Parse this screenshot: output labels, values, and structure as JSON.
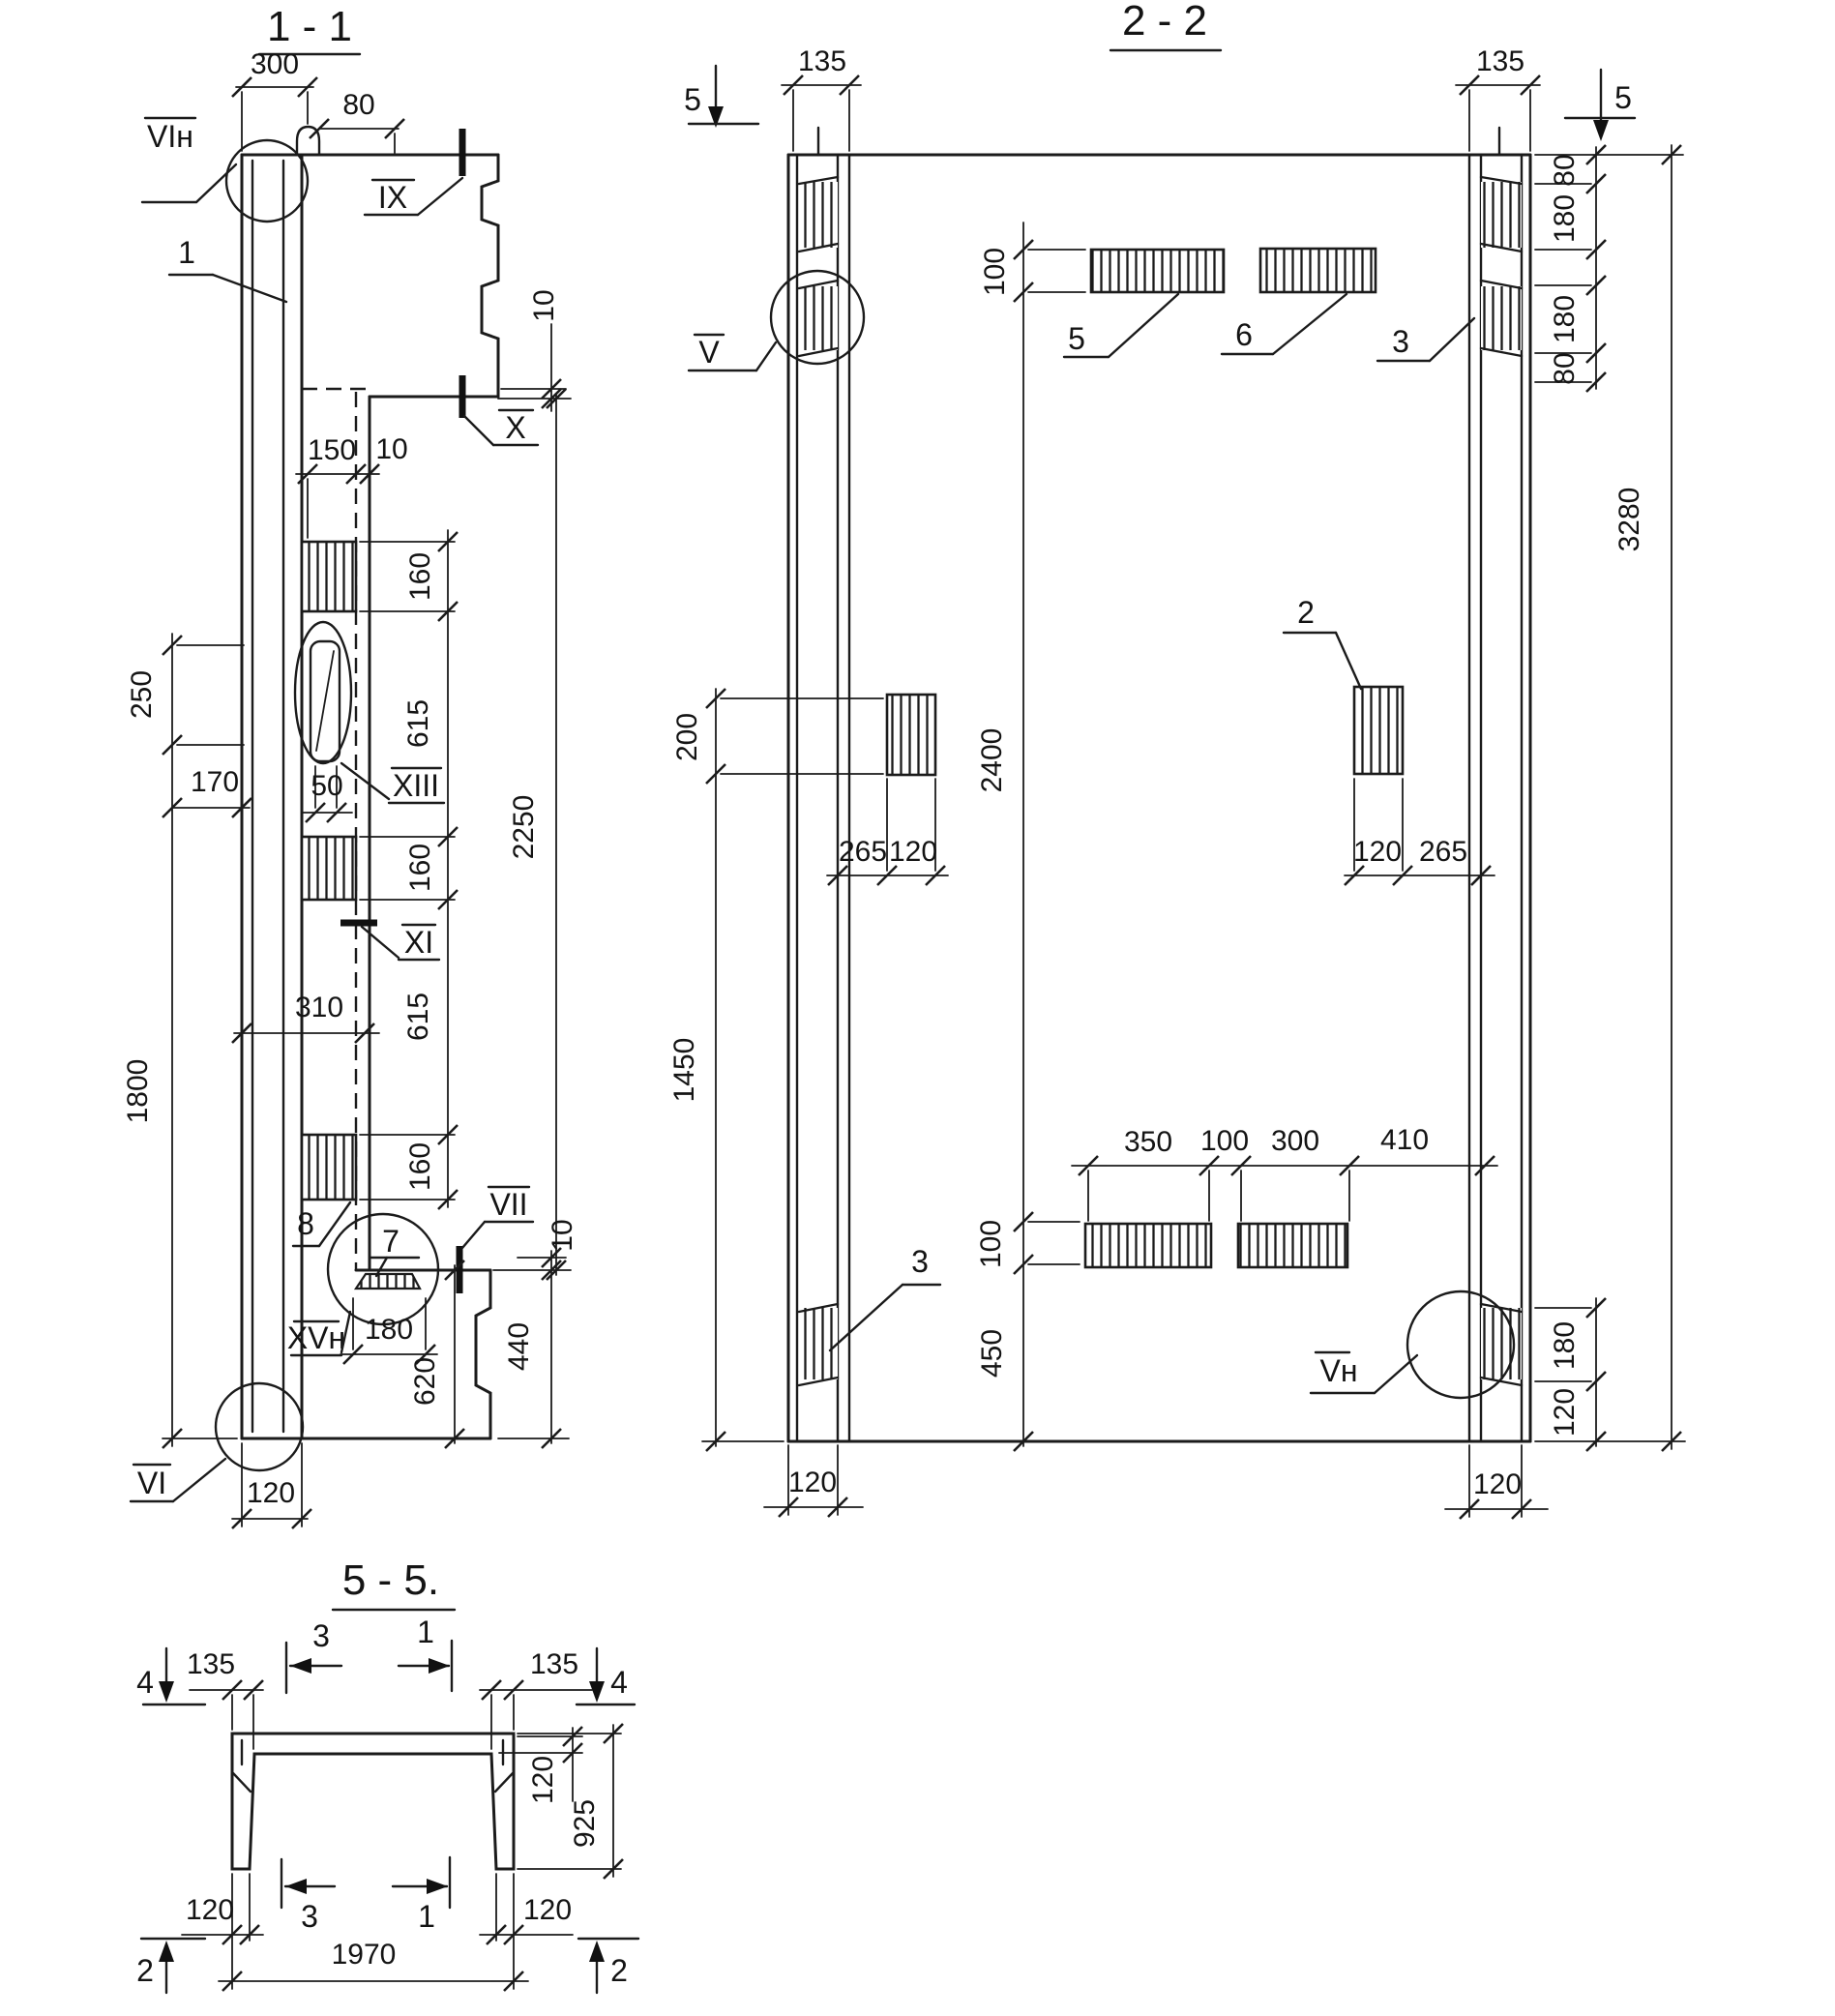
{
  "s11": {
    "title": "1 - 1",
    "labels": {
      "vi_n": "VIн",
      "one": "1",
      "ix": "IX",
      "x": "X",
      "xiii": "XIII",
      "xi": "XI",
      "eight": "8",
      "seven": "7",
      "vii": "VII",
      "xv_n": "XVн",
      "vi": "VI"
    },
    "dims": {
      "w300": "300",
      "w80": "80",
      "t10": "10",
      "w150": "150",
      "w10": "10",
      "h160a": "160",
      "h615a": "615",
      "h160b": "160",
      "h615b": "615",
      "h160c": "160",
      "h2250": "2250",
      "h250": "250",
      "w170": "170",
      "w50": "50",
      "w310": "310",
      "h1800": "1800",
      "w120": "120",
      "w180": "180",
      "h620": "620",
      "h440": "440",
      "b10": "10"
    }
  },
  "s22": {
    "title": "2 - 2",
    "cuts": {
      "left": "5",
      "right": "5"
    },
    "labels": {
      "v": "V",
      "five": "5",
      "six": "6",
      "three_top": "3",
      "two": "2",
      "three_bottom": "3",
      "v_n": "Vн"
    },
    "dims": {
      "w135l": "135",
      "w135r": "135",
      "h100t": "100",
      "h2400": "2400",
      "h100b": "100",
      "h450": "450",
      "h200": "200",
      "h1450": "1450",
      "w265l": "265",
      "w120l": "120",
      "w120r": "120",
      "w265r": "265",
      "h80a": "80",
      "h180a": "180",
      "h180b": "180",
      "h80b": "80",
      "h180r": "180",
      "h120r": "120",
      "h3280": "3280",
      "w350": "350",
      "w100": "100",
      "w300": "300",
      "w410": "410",
      "w120bl": "120",
      "w120br": "120"
    }
  },
  "s55": {
    "title": "5 - 5.",
    "markers": {
      "four_l": "4",
      "four_r": "4",
      "three_t": "3",
      "one_t": "1",
      "three_b": "3",
      "one_b": "1",
      "two_l": "2",
      "two_r": "2"
    },
    "dims": {
      "w135l": "135",
      "w135r": "135",
      "t120": "120",
      "h925": "925",
      "w120bl": "120",
      "w120br": "120",
      "w1970": "1970"
    }
  }
}
